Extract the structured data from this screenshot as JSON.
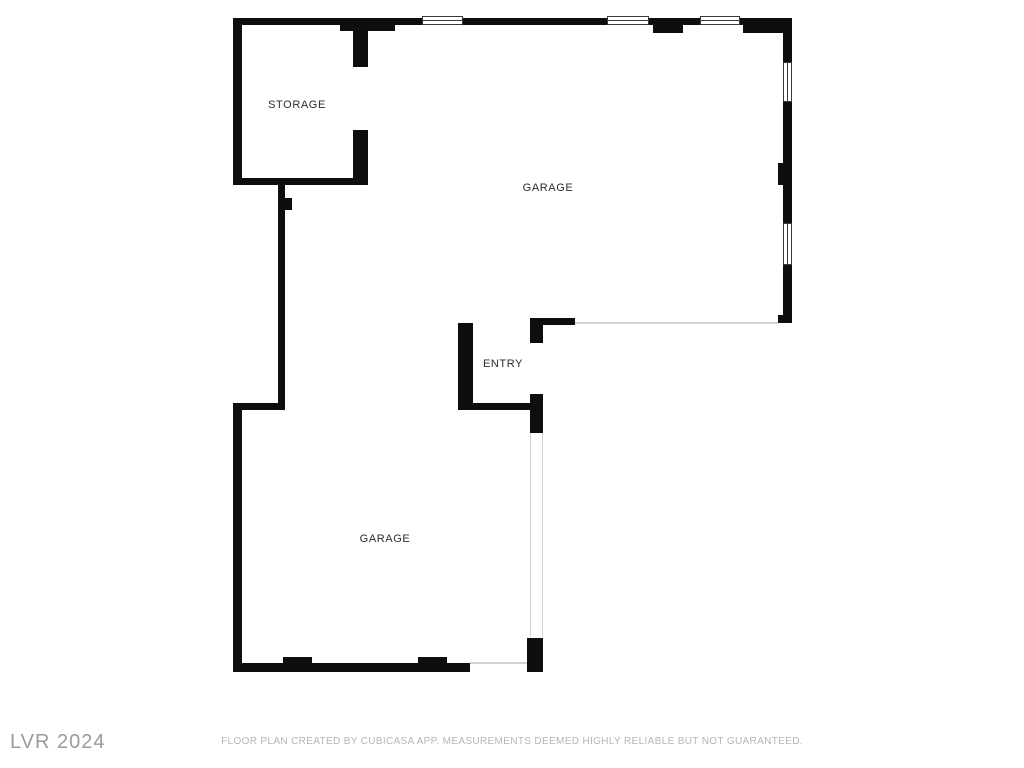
{
  "document": {
    "type": "floor-plan",
    "creator_note": "FLOOR PLAN CREATED BY CUBICASA APP. MEASUREMENTS DEEMED HIGHLY RELIABLE BUT NOT GUARANTEED.",
    "watermark": "LVR 2024"
  },
  "rooms": [
    {
      "id": "storage",
      "label": "STORAGE"
    },
    {
      "id": "garage-upper",
      "label": "GARAGE"
    },
    {
      "id": "entry",
      "label": "ENTRY"
    },
    {
      "id": "garage-lower",
      "label": "GARAGE"
    }
  ],
  "features": {
    "windows_top_wall": 3,
    "windows_right_wall": 2,
    "door_openings": [
      "storage-door",
      "entry-door",
      "garage-lower-right-opening",
      "garage-lower-door-opening"
    ]
  },
  "colors": {
    "wall": "#0e0e0e",
    "window_border": "#3a3a3a",
    "thin_line": "#d2d2d2",
    "label": "#2b2b2b",
    "footer_text": "#b5b5b5",
    "watermark_text": "#9a9a9a",
    "paper": "#ffffff"
  }
}
